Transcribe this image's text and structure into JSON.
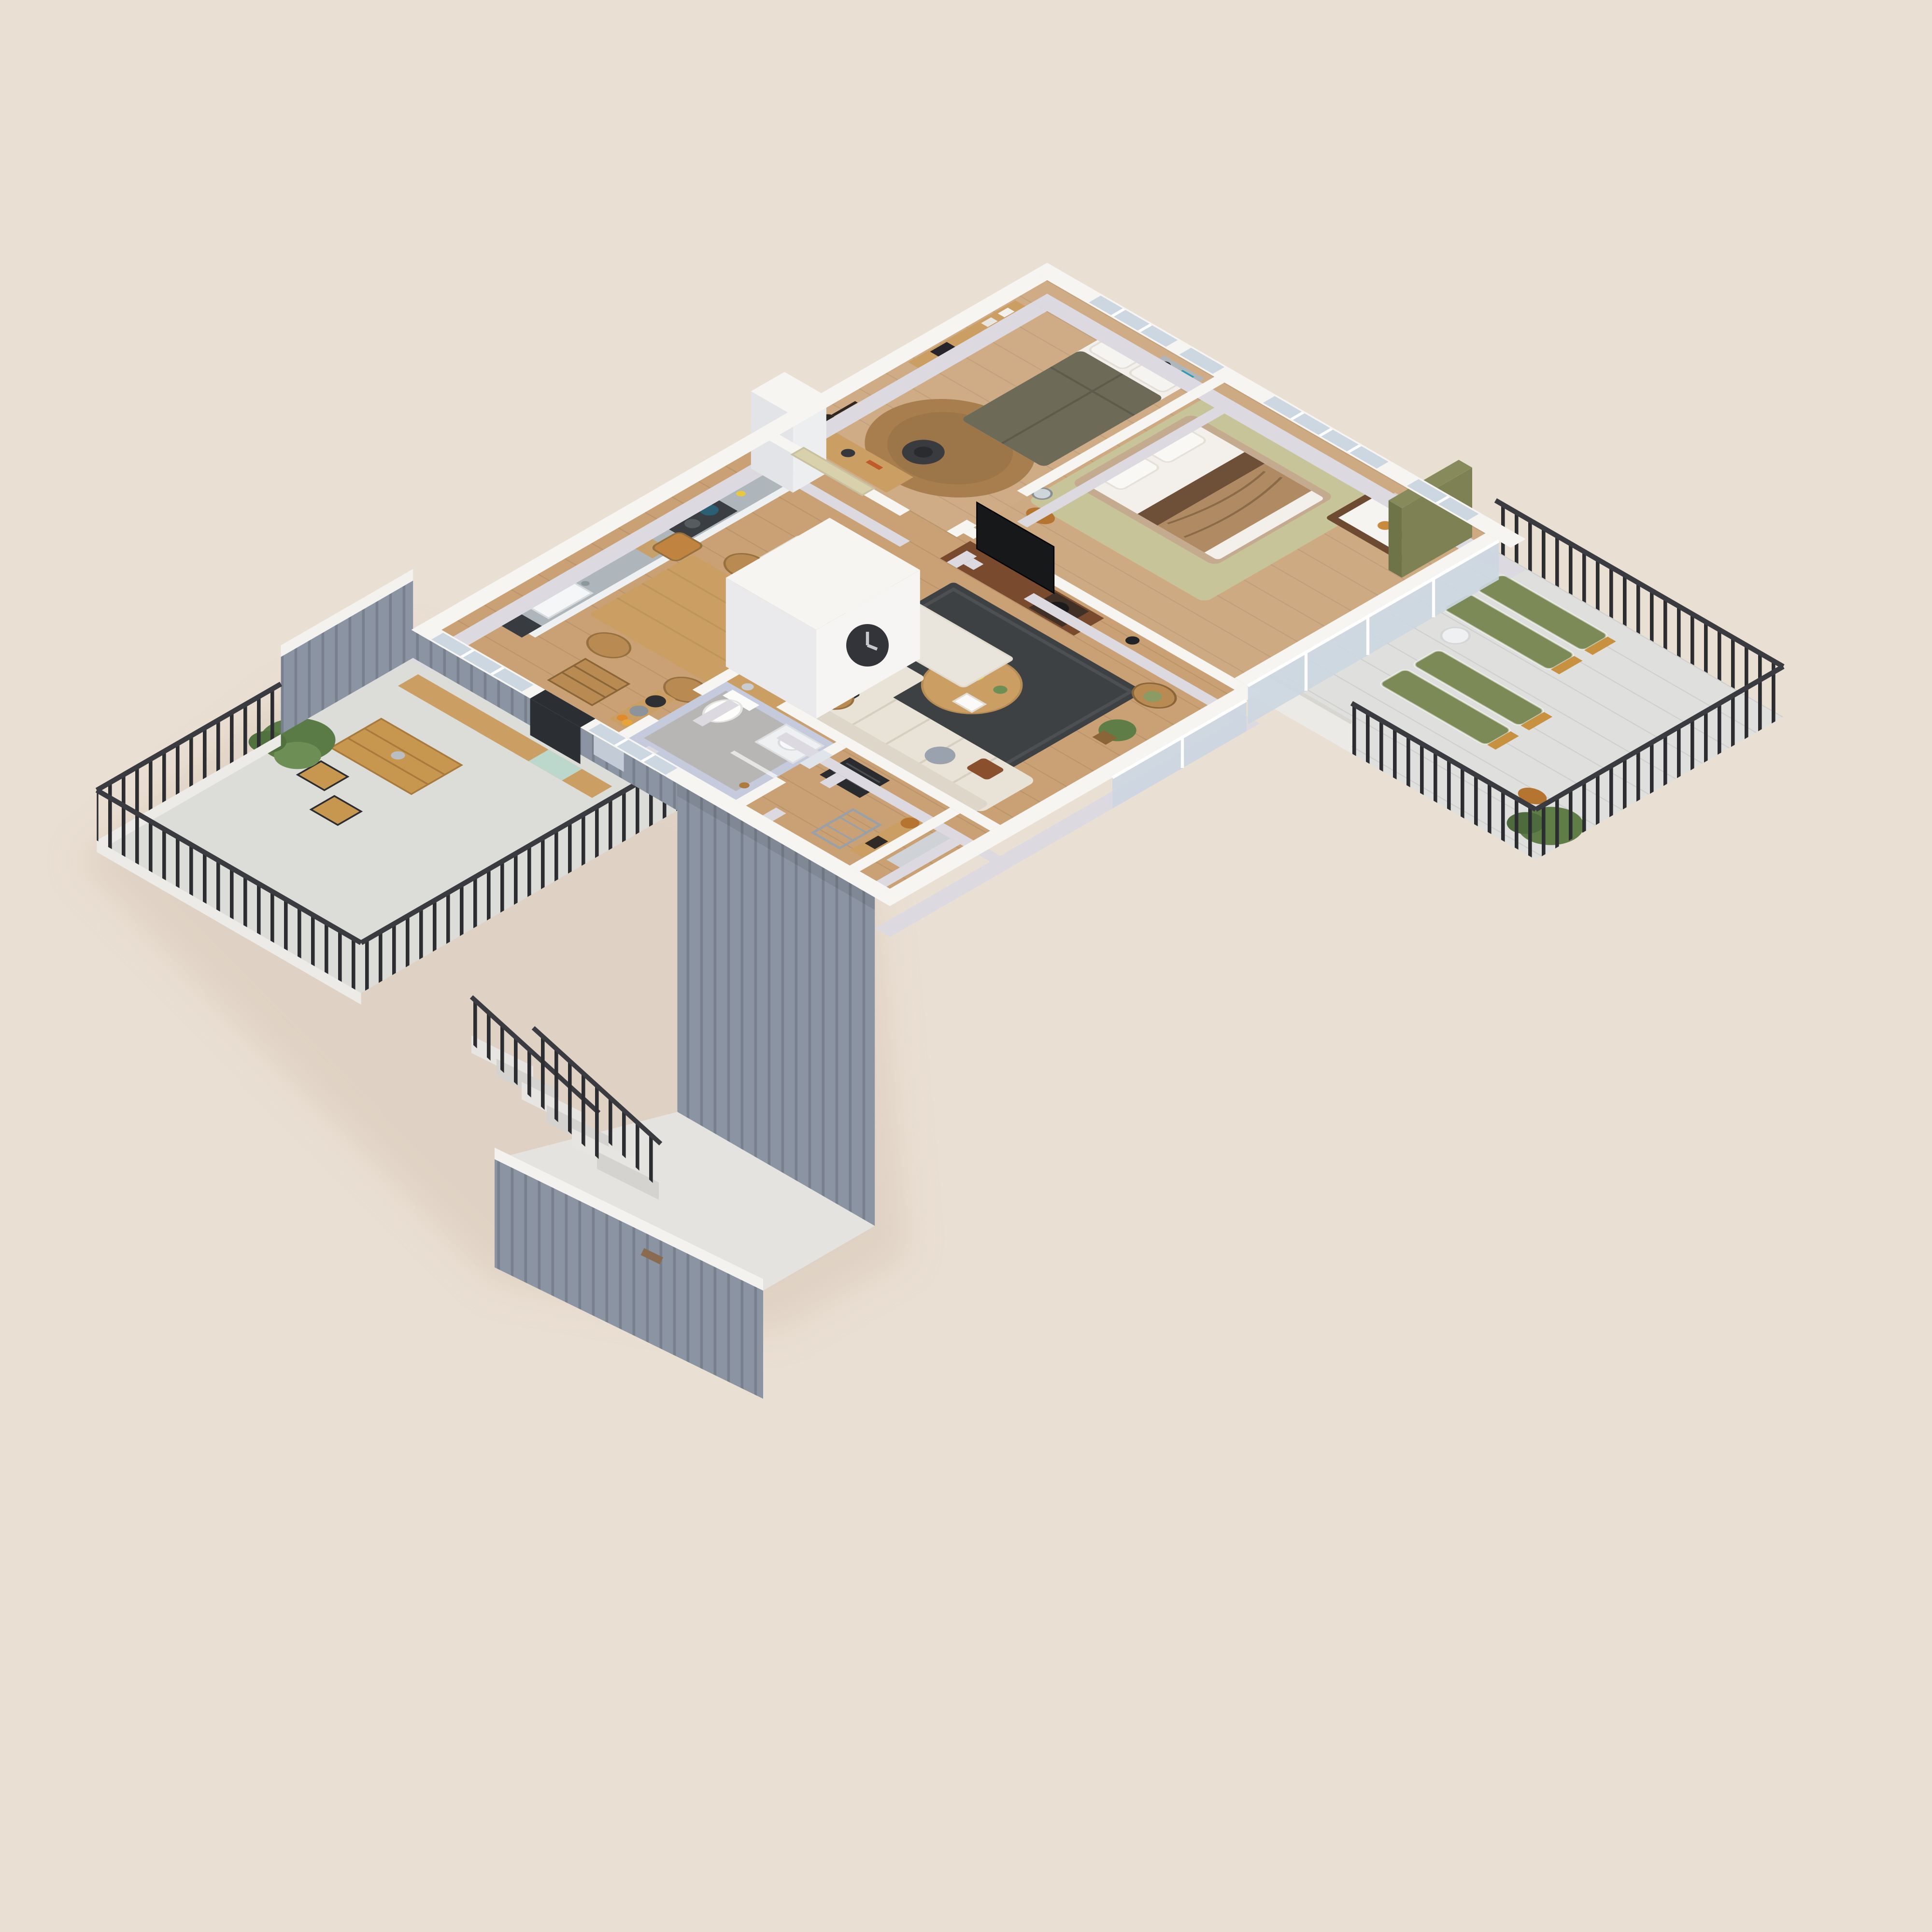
{
  "scene": {
    "type": "isometric-3d-floor-plan-render",
    "background_color": "#eadfd3",
    "colors": {
      "wall_top": "#f7f5f2",
      "wall_side": "#dcdae0",
      "cladding": "#8b94a3",
      "cladding_dark": "#76808f",
      "wood_floor": "#c9a175",
      "terrace_floor": "#dcdcd9",
      "balcony_floor": "#dfe0dd",
      "courtyard_floor": "#e4e3e0",
      "concrete": "#b7b6b4",
      "rug_dark": "#3e4144",
      "rug_olive": "#c8c49a",
      "rug_jute": "#a87e4e",
      "rug_runner": "#eae5dc",
      "sofa": "#e9e3d7",
      "bed_frame": "#c4aa8f",
      "duvet_white": "#f3f0ec",
      "duvet_olive": "#6e6a58",
      "throw_brown": "#b08a62",
      "wood_furniture": "#cb9f63",
      "wood_mid": "#b98a52",
      "walnut": "#7a4a2e",
      "crib_wood": "#6f4a33",
      "green_accent": "#7d8153",
      "lounger_green": "#7c8a57",
      "plant_green": "#5f7d46",
      "railing_black": "#2c2d31",
      "door_black": "#2b2e33",
      "glass_blue": "#ccd7e1",
      "tile_blue": "#c5cbdc",
      "counter_gray": "#aeb6bb",
      "amber": "#b5742f",
      "yellow": "#e8c93e",
      "teal": "#2e9bb5",
      "tv_black": "#17181a",
      "heater_black": "#2a2b2e",
      "white_goods": "#eef0f2",
      "shadow": "#d7c8b8"
    },
    "rooms": [
      {
        "id": "bedroom",
        "name": "Bedroom",
        "furniture": [
          "double bed with olive duvet",
          "white pillows",
          "wall shelf with books and black box",
          "desk",
          "world map poster",
          "black office chair",
          "round jute rug",
          "wall guitar",
          "window nook desk with globe lamp and teal box"
        ]
      },
      {
        "id": "master-bedroom",
        "name": "Master bedroom with nursery corner",
        "furniture": [
          "upholstered double bed",
          "white duvet",
          "tan and brown throw",
          "pale olive rug",
          "wooden stool",
          "round mirror",
          "baby crib with teddy bear",
          "olive green wardrobe panel",
          "window dresser with lamp"
        ]
      },
      {
        "id": "living-room",
        "name": "Living room",
        "furniture": [
          "walnut media console",
          "TV",
          "turntable",
          "charcoal area rug",
          "cream sectional sofa",
          "patterned cushion",
          "knot cushion",
          "rust cushion",
          "round wooden coffee table",
          "yellow tray",
          "open book",
          "rattan armchair",
          "potted plants",
          "floor lamp",
          "wall clock on closet volume"
        ]
      },
      {
        "id": "kitchen",
        "name": "Kitchen",
        "furniture": [
          "white cabinet run",
          "speckled gray countertop",
          "sink",
          "dark cooktop with pans",
          "tall white cabinet",
          "appliance front"
        ]
      },
      {
        "id": "dining-area",
        "name": "Dining area",
        "furniture": [
          "oak dining table",
          "five wooden chairs",
          "child high chair",
          "off-white runner rug",
          "potted plant",
          "moka pot"
        ]
      },
      {
        "id": "bathroom",
        "name": "Bathroom",
        "furniture": [
          "toilet",
          "white vanity washbasin",
          "mirror",
          "glass shower partition",
          "brass shower fixture",
          "blue-gray tiled walls",
          "concrete floor"
        ]
      },
      {
        "id": "utility-room",
        "name": "Utility room",
        "furniture": [
          "black heater unit",
          "wooden wall shelf",
          "woven basket",
          "black box",
          "drying rack"
        ]
      },
      {
        "id": "entry",
        "name": "Entry hall",
        "furniture": [
          "black front door",
          "woven storage chest",
          "wall shelf with two hats",
          "oranges"
        ]
      },
      {
        "id": "balcony",
        "name": "Balcony",
        "furniture": [
          "four green slatted loungers with wood armrests",
          "white side table",
          "wooden stool",
          "large potted plant",
          "black metal bar railing",
          "concrete deck",
          "glazed sliding walls"
        ]
      },
      {
        "id": "terrace",
        "name": "Terrace",
        "furniture": [
          "long wooden bench with mint cushion",
          "folding wooden table",
          "two folding chairs",
          "potted tree",
          "black metal bar railing",
          "gray clad parapet wall with white cap"
        ]
      },
      {
        "id": "stairwell",
        "name": "Outdoor stair and lower courtyard",
        "furniture": [
          "concrete steps",
          "black stair railings",
          "gray clad walls with white caps",
          "address plaque"
        ]
      }
    ]
  }
}
